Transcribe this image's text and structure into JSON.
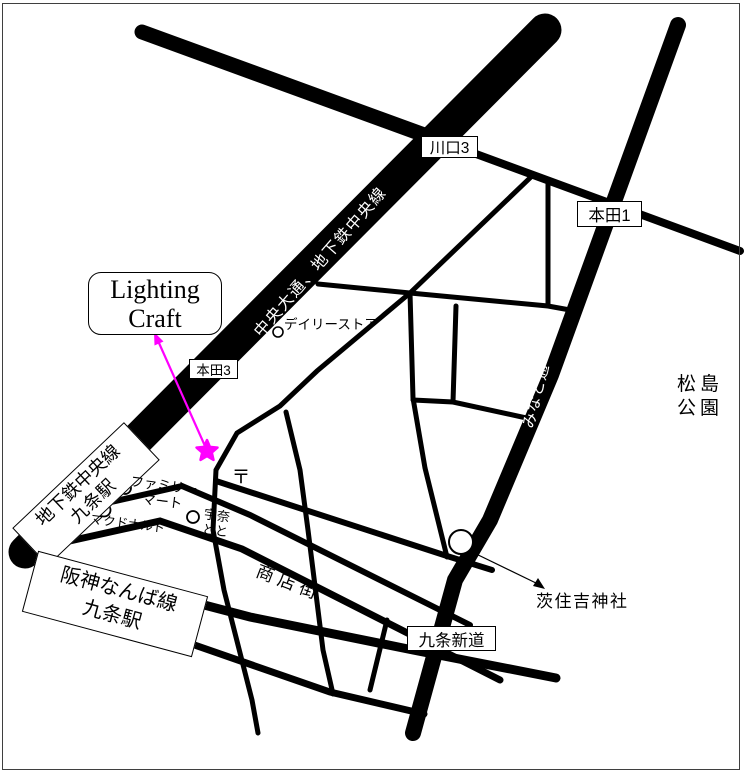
{
  "colors": {
    "road": "#000000",
    "road_text": "#ffffff",
    "accent_magenta": "#ff00ff",
    "frame": "#3f3f3f"
  },
  "destination": {
    "name_line1": "Lighting",
    "name_line2": "Craft"
  },
  "roads": {
    "chuo_label": "中央大通、地下鉄中央線",
    "minato_label": "みなと通",
    "shotengai_label": "商店街"
  },
  "intersections": {
    "kawaguchi3": "川口3",
    "honda1": "本田1",
    "honda3": "本田3",
    "kujo_shindo": "九条新道"
  },
  "stations": {
    "chikatetsu_line1": "地下鉄中央線",
    "chikatetsu_line2": "九条駅",
    "hanshin_line1": "阪神なんば線",
    "hanshin_line2": "九条駅"
  },
  "pois": {
    "daily_store": "デイリーストア",
    "family_mart_line1": "ファミリー",
    "family_mart_line2": "マート",
    "mcdonalds": "マクドナルド",
    "unatoto_line1": "宇奈",
    "unatoto_line2": "とと",
    "ibasumiyoshi_shrine": "茨住吉神社",
    "matsushima_line1": "松島",
    "matsushima_line2": "公園",
    "post_office_mark": "〒"
  }
}
